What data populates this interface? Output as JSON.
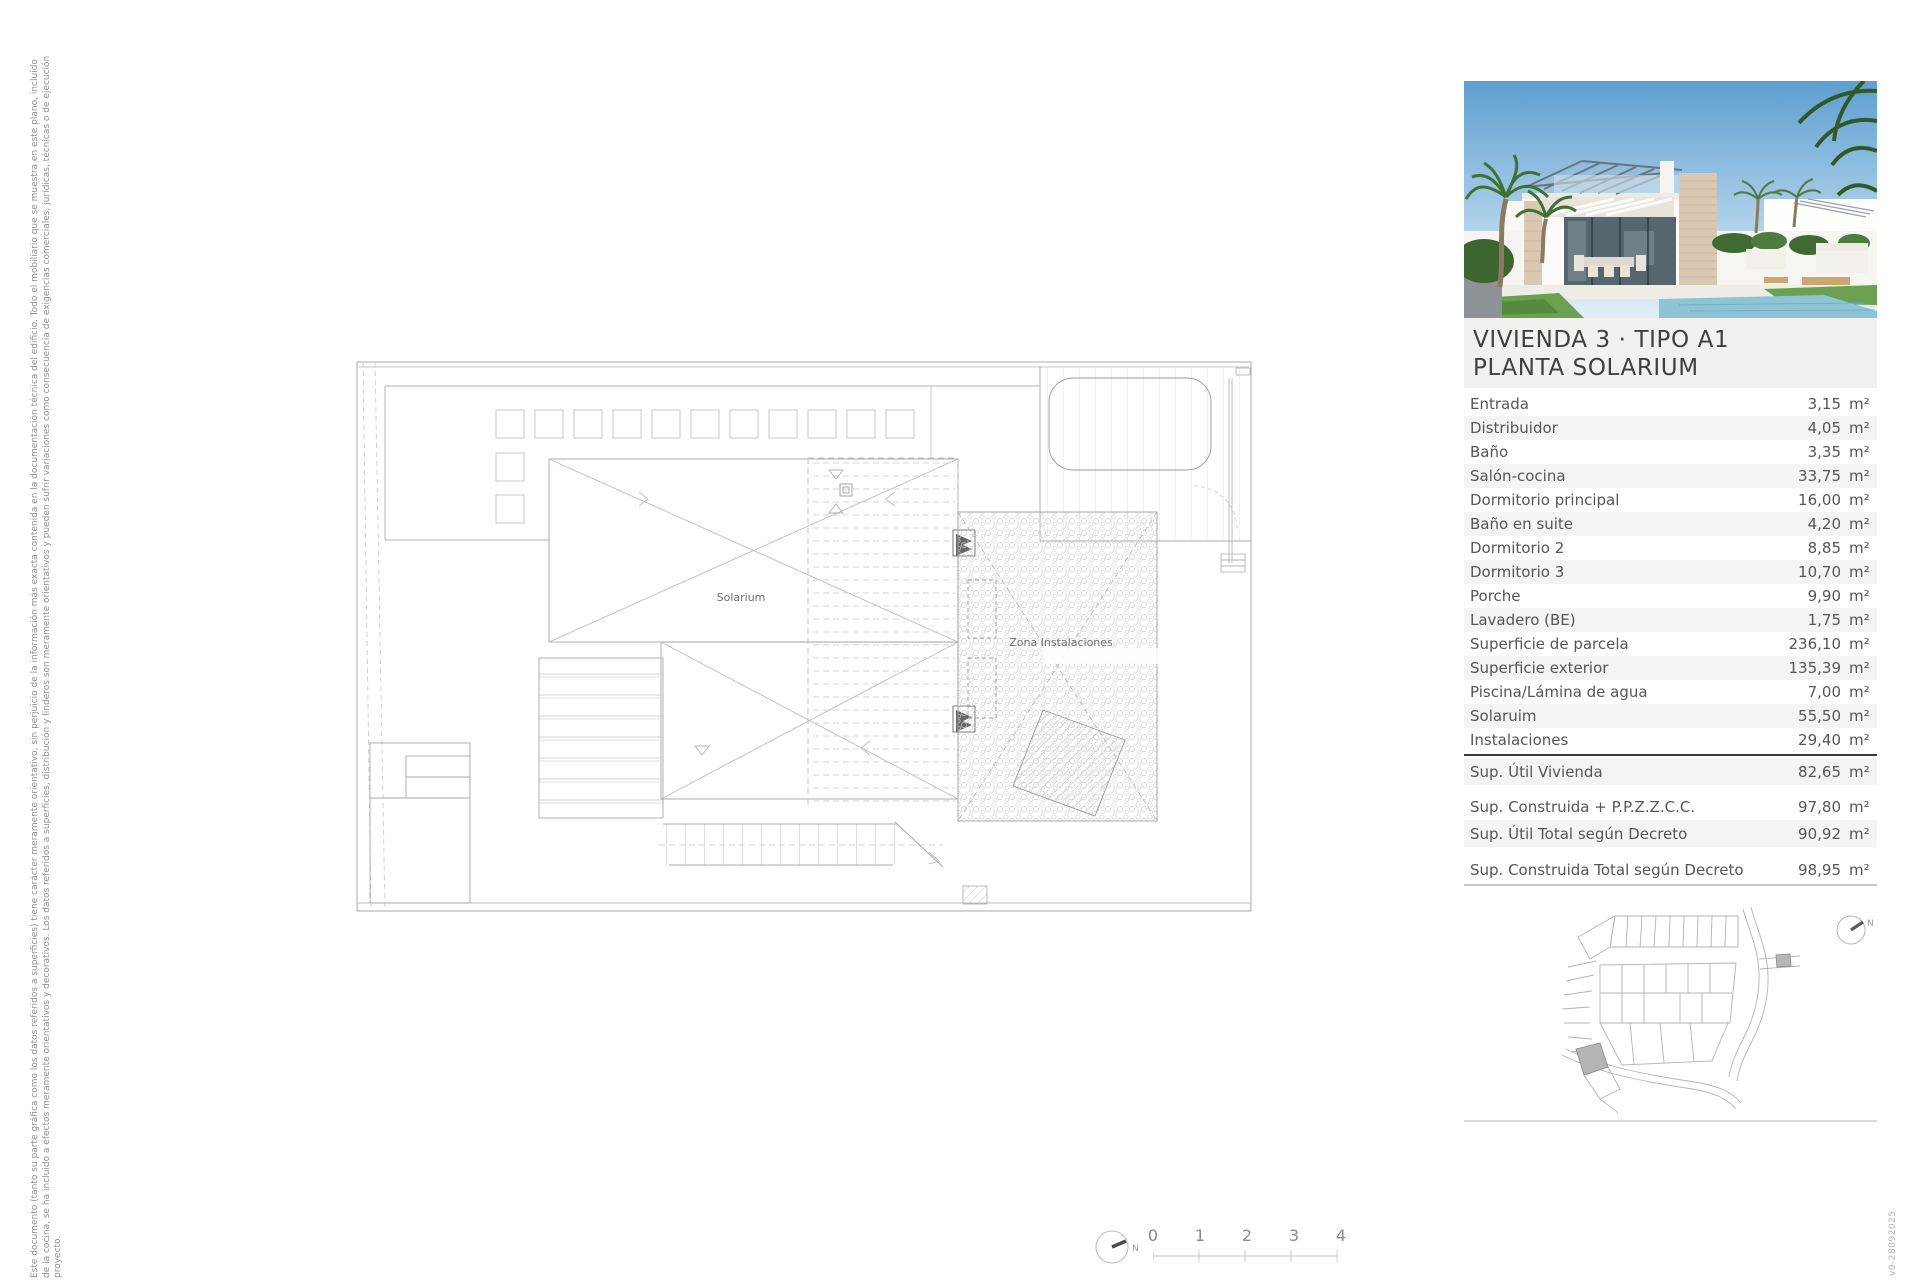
{
  "document": {
    "side_note_lines": [
      "Este documento (tanto su parte gráfica como los datos referidos a superficies) tiene carácter meramente orientativo, sin perjuicio de la información más exacta contenida en la documentación técnica del edificio. Todo el mobiliario que se muestra en este plano, incluido",
      "de la cocina, se ha incluido a efectos meramente orientativos y decorativos. Los datos referidos a superficies, distribución y linderos son meramente orientativos y pueden sufrir variaciones como consecuencia de exigencias comerciales, jurídicas, técnicas o de ejecución",
      "proyecto."
    ],
    "version_label": "v0-28092025"
  },
  "plan": {
    "labels": {
      "solarium": "Solarium",
      "zona_instalaciones": "Zona Instalaciones"
    }
  },
  "panel": {
    "title_line1": "VIVIENDA 3 · TIPO A1",
    "title_line2": "PLANTA SOLARIUM",
    "unit": "m²",
    "rooms": [
      {
        "label": "Entrada",
        "value": "3,15"
      },
      {
        "label": "Distribuidor",
        "value": "4,05"
      },
      {
        "label": "Baño",
        "value": "3,35"
      },
      {
        "label": "Salón-cocina",
        "value": "33,75"
      },
      {
        "label": "Dormitorio principal",
        "value": "16,00"
      },
      {
        "label": "Baño en suite",
        "value": "4,20"
      },
      {
        "label": "Dormitorio 2",
        "value": "8,85"
      },
      {
        "label": "Dormitorio 3",
        "value": "10,70"
      },
      {
        "label": "Porche",
        "value": "9,90"
      },
      {
        "label": "Lavadero (BE)",
        "value": "1,75"
      },
      {
        "label": "Superficie de parcela",
        "value": "236,10"
      },
      {
        "label": "Superficie exterior",
        "value": "135,39"
      },
      {
        "label": "Piscina/Lámina de agua",
        "value": "7,00"
      },
      {
        "label": "Solaruim",
        "value": "55,50"
      },
      {
        "label": "Instalaciones",
        "value": "29,40"
      }
    ],
    "summary": [
      {
        "label": "Sup. Útil Vivienda",
        "value": "82,65"
      },
      {
        "label": "Sup. Construida + P.P.Z.Z.C.C.",
        "value": "97,80"
      },
      {
        "label": "Sup. Útil Total según Decreto",
        "value": "90,92"
      },
      {
        "label": "Sup. Construida Total según Decreto",
        "value": "98,95"
      }
    ]
  },
  "compass": {
    "north_label": "N"
  },
  "scale_bar": {
    "ticks": [
      "0",
      "1",
      "2",
      "3",
      "4"
    ]
  },
  "colors": {
    "row_alt": "#f4f4f4",
    "title_bg": "#f1f1ef",
    "rule_dark": "#3a3a3a",
    "rule_light": "#c6c6c6",
    "plot_highlight": "#b5b5b5"
  }
}
